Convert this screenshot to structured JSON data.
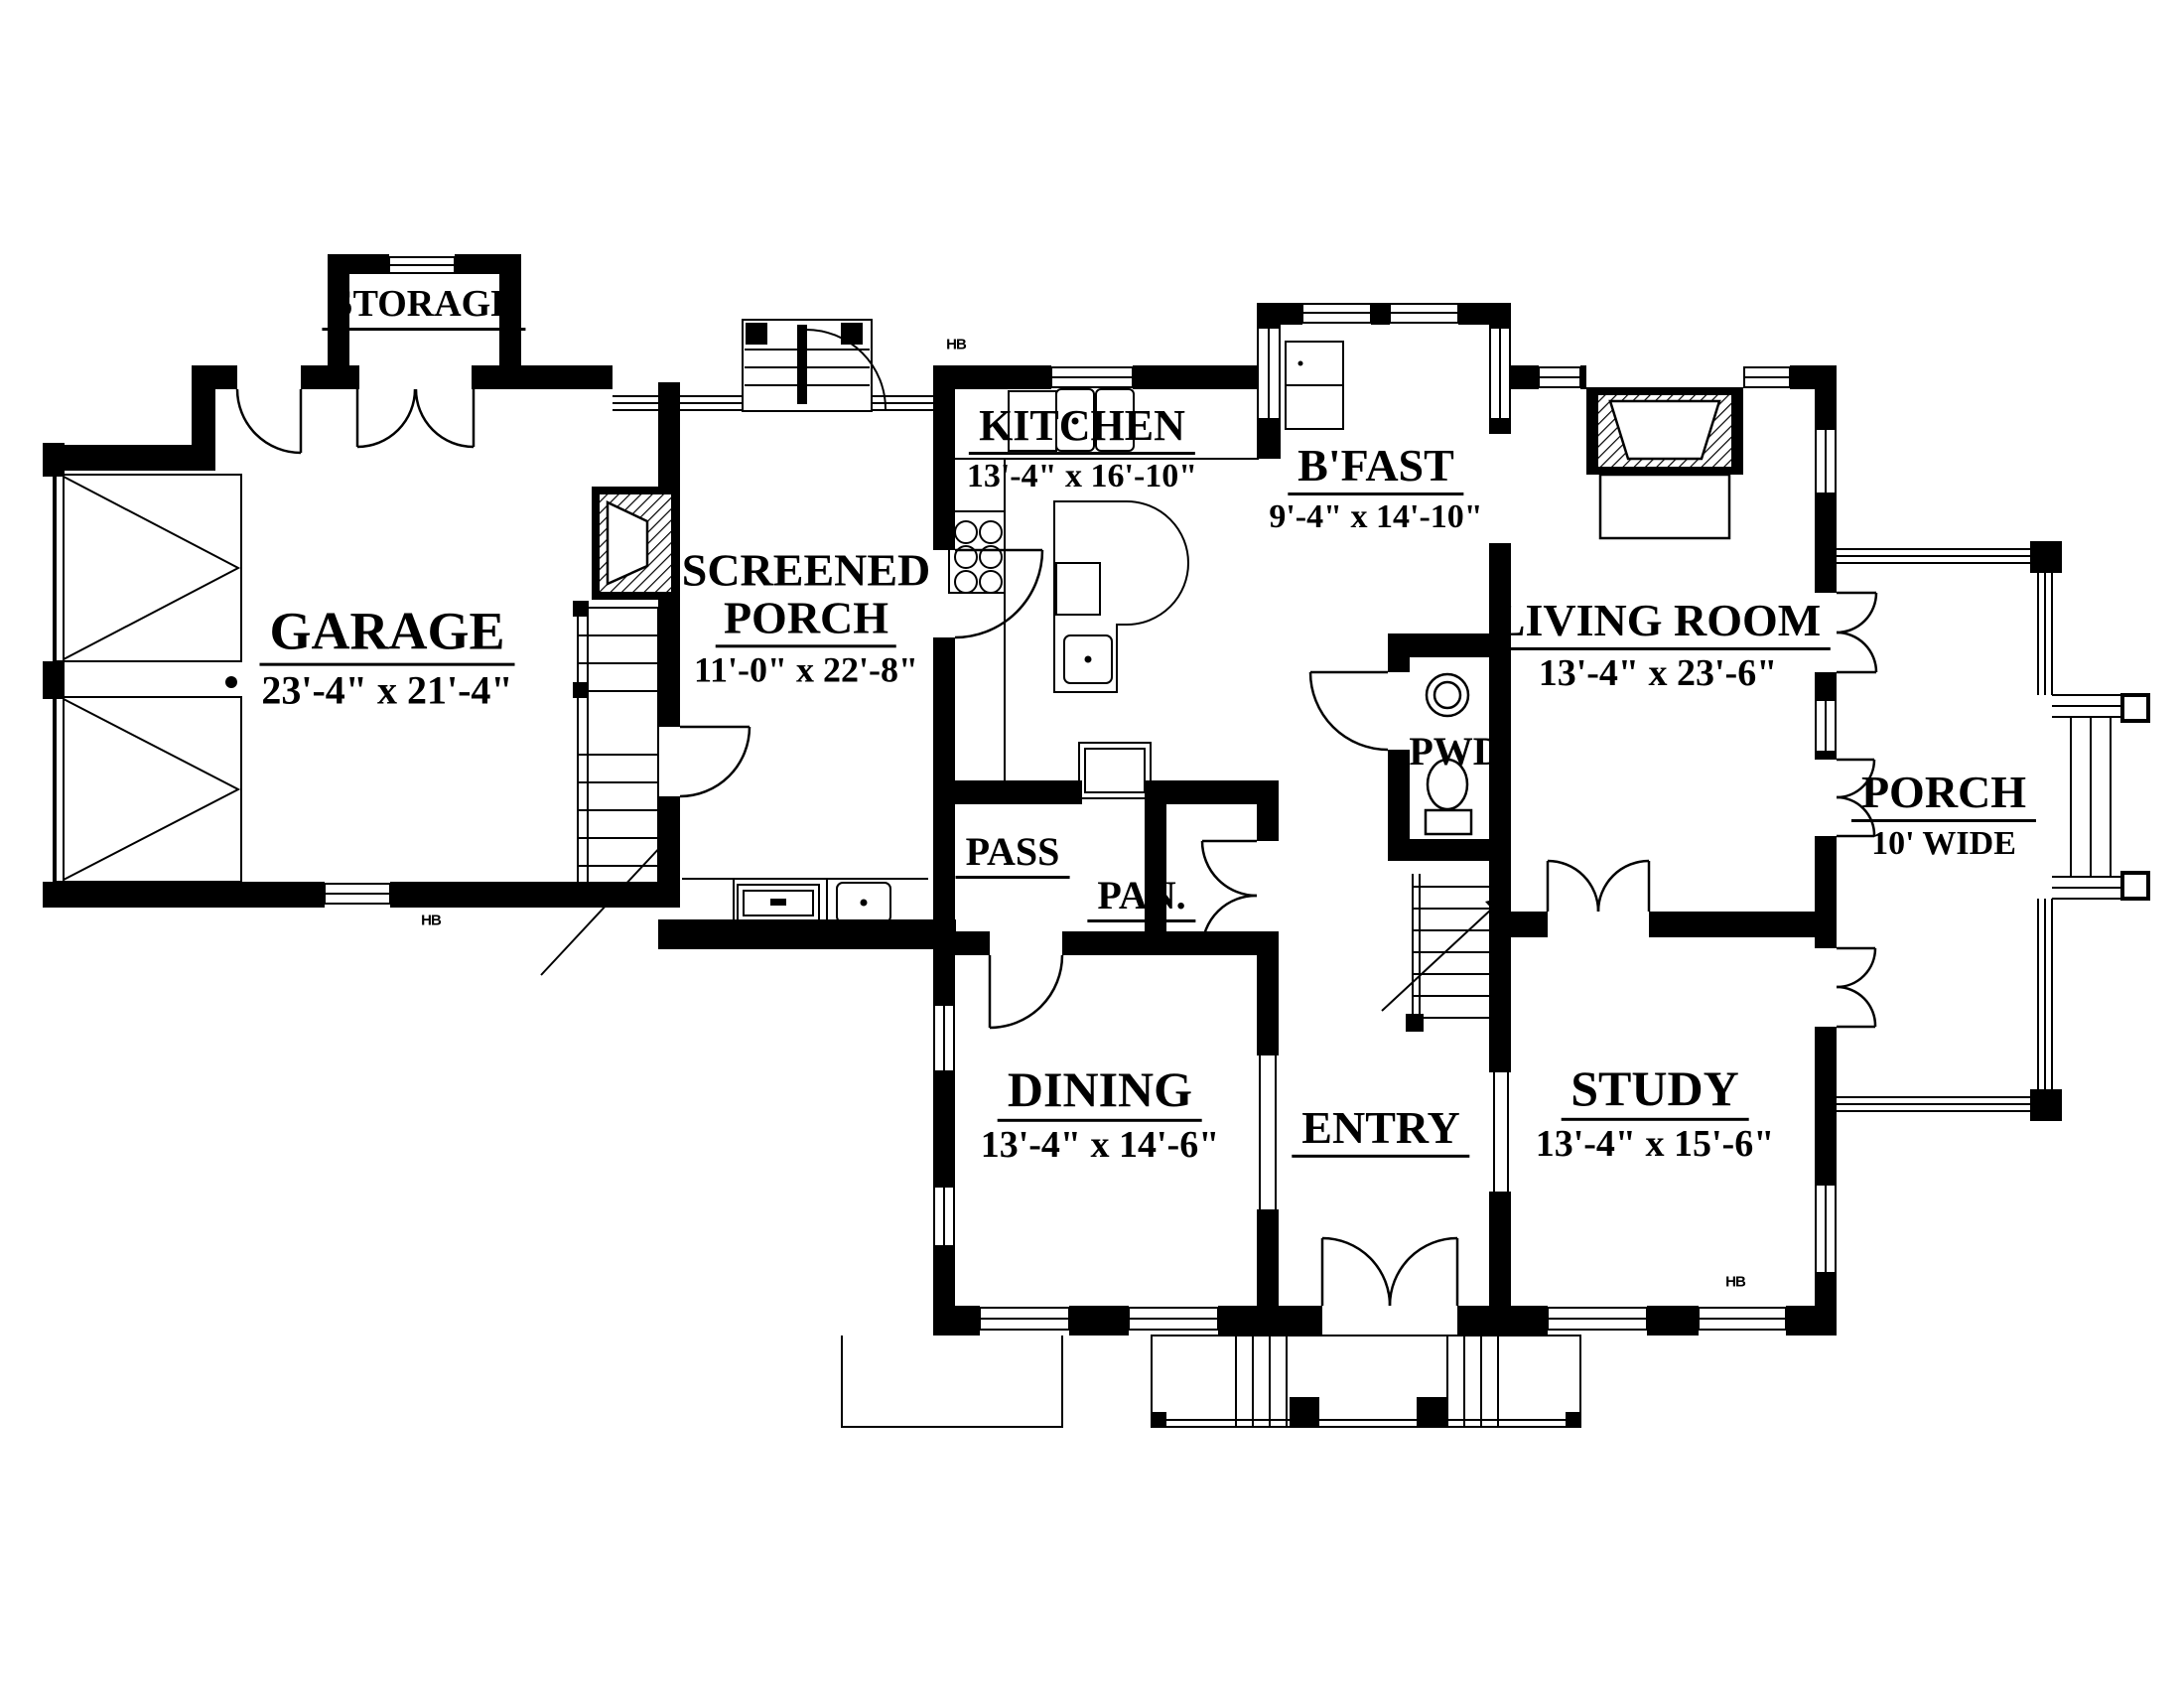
{
  "colors": {
    "ink": "#000000",
    "paper": "#ffffff"
  },
  "rooms": {
    "storage": {
      "name": "STORAGE"
    },
    "garage": {
      "name": "GARAGE",
      "dims": "23'-4\" x 21'-4\""
    },
    "screened_porch": {
      "name_line1": "SCREENED",
      "name_line2": "PORCH",
      "dims": "11'-0\" x 22'-8\""
    },
    "kitchen": {
      "name": "KITCHEN",
      "dims": "13'-4\" x 16'-10\""
    },
    "bfast": {
      "name": "B'FAST",
      "dims": "9'-4\" x 14'-10\""
    },
    "living_room": {
      "name": "LIVING ROOM",
      "dims": "13'-4\" x 23'-6\""
    },
    "porch": {
      "name": "PORCH",
      "dims": "10' WIDE"
    },
    "pwd": {
      "name": "PWD"
    },
    "pass": {
      "name": "PASS"
    },
    "pantry": {
      "name": "PAN."
    },
    "dining": {
      "name": "DINING",
      "dims": "13'-4\" x 14'-6\""
    },
    "entry": {
      "name": "ENTRY"
    },
    "study": {
      "name": "STUDY",
      "dims": "13'-4\" x 15'-6\""
    }
  },
  "annotations": {
    "hose_bib": "HB"
  }
}
